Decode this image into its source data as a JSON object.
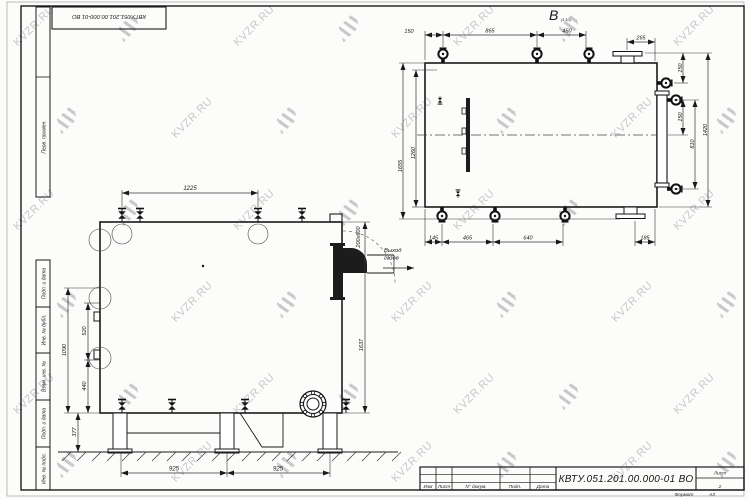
{
  "watermark": {
    "text": "KVZR.RU"
  },
  "frame": {
    "stamp_doc": "КВТУ.051.201.00.000-01 ВО",
    "col_top": "Перв. примен.",
    "col_1": "Подп. и дата",
    "col_2": "Инв. № дубл.",
    "col_3": "Взам. инв. №",
    "col_4": "Подп. и дата",
    "col_5": "Инв. № подл."
  },
  "title_block": {
    "doc_number": "КВТУ.051.201.00.000-01 ВО",
    "col_izm": "Изм",
    "col_list": "Лист",
    "col_doc": "N° докум.",
    "col_podp": "Подп.",
    "col_data": "Дата",
    "sheet_label": "Лист",
    "sheet_number": "2",
    "format_label": "Формат",
    "format_value": "А3"
  },
  "front_view": {
    "dim_top": "1225",
    "dim_bottom_left": "925",
    "dim_bottom_right": "925",
    "dim_height_outer": "1090",
    "dim_height_520": "520",
    "dim_height_440": "440",
    "dim_height_377": "377",
    "dim_right_height": "1637",
    "outlet_section": "200х600",
    "outlet_note_line1": "Выход",
    "outlet_note_line2": "газов"
  },
  "top_view": {
    "view_label": "В",
    "view_scale": "(1:10)",
    "dim_top_1": "150",
    "dim_top_2": "865",
    "dim_top_3": "450",
    "dim_top_4": "265",
    "dim_right_1": "150",
    "dim_right_2": "150",
    "dim_right_3": "810",
    "dim_right_4": "1420",
    "dim_left_outer": "1655",
    "dim_left_inner": "1260",
    "dim_bottom_1": "145",
    "dim_bottom_2": "465",
    "dim_bottom_3": "640",
    "dim_bottom_4": "185"
  }
}
